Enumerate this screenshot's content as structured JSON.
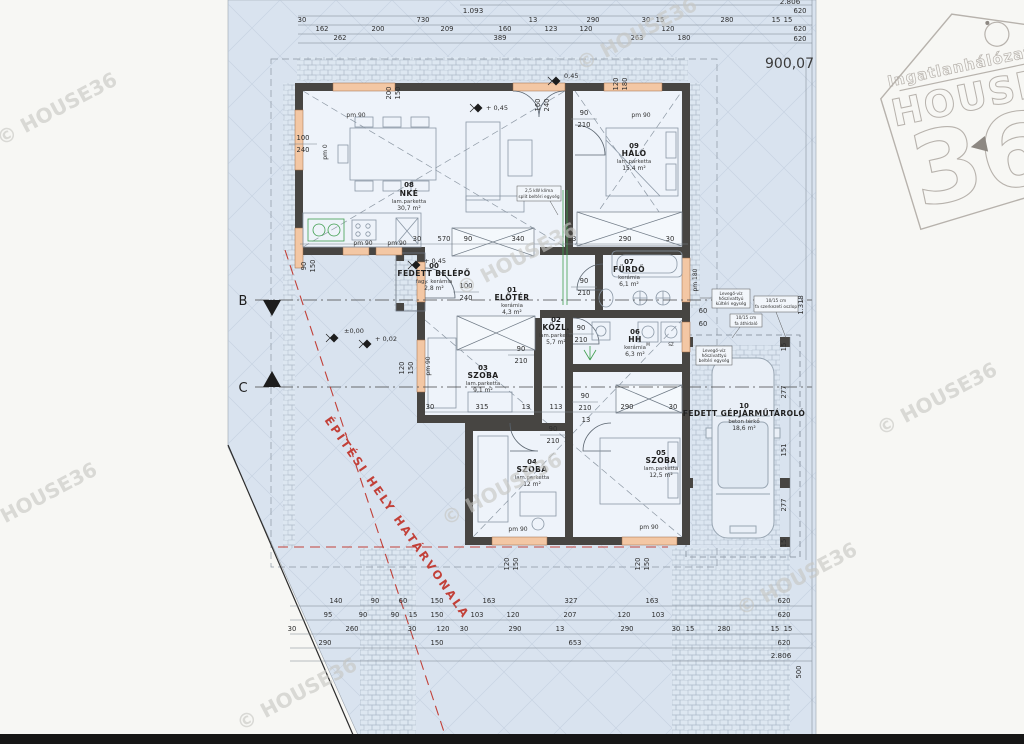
{
  "plot_number": "900,07",
  "watermark": "© HOUSE36",
  "boundary_label": "ÉPÍTÉSI HELY HATÁRVONALA",
  "logo": {
    "tagline": "Ingatlanhálózat",
    "name": "HOUSE",
    "number": "36"
  },
  "sections": {
    "b": "B",
    "c": "C"
  },
  "levels": {
    "zero": "±0,00",
    "p002": "+ 0,02",
    "p045": "+ 0,45",
    "v045": "0,45"
  },
  "pm": {
    "pm90": "pm 90",
    "pm0": "pm 0",
    "pm180": "pm 180"
  },
  "appliances": {
    "m": "M",
    "sz": "SZ"
  },
  "rooms": [
    {
      "num": "00",
      "name": "FEDETT BELÉPŐ",
      "material": "fagy. kerámia",
      "area": "2,8 m²"
    },
    {
      "num": "01",
      "name": "ELŐTÉR",
      "material": "kerámia",
      "area": "4,3 m²"
    },
    {
      "num": "02",
      "name": "KÖZL.",
      "material": "lam.parketta",
      "area": "5,7 m²"
    },
    {
      "num": "03",
      "name": "SZOBA",
      "material": "lam.parketta",
      "area": "9,1 m²"
    },
    {
      "num": "04",
      "name": "SZOBA",
      "material": "lam.parketta",
      "area": "12 m²"
    },
    {
      "num": "05",
      "name": "SZOBA",
      "material": "lam.parketta",
      "area": "12,5 m²"
    },
    {
      "num": "06",
      "name": "HH",
      "material": "kerámia",
      "area": "6,3 m²"
    },
    {
      "num": "07",
      "name": "FÜRDŐ",
      "material": "kerámia",
      "area": "6,1 m²"
    },
    {
      "num": "08",
      "name": "NKÉ",
      "material": "lam.parketta",
      "area": "30,7 m²"
    },
    {
      "num": "09",
      "name": "HÁLÓ",
      "material": "lam.parketta",
      "area": "15,4 m²"
    },
    {
      "num": "10",
      "name": "FEDETT GÉPJÁRMŰTÁROLÓ",
      "material": "beton térkő",
      "area": "18,6 m²"
    }
  ],
  "notes": {
    "klima": [
      "2,5 kW klíma",
      "split beltéri egység"
    ],
    "hp_out": [
      "Levegő-víz",
      "hőszivattyú",
      "kültéri egység"
    ],
    "post": [
      "10/15 cm",
      "fa szerkezeti oszlop"
    ],
    "lintel": [
      "10/15 cm",
      "fa áthidaló"
    ],
    "hp_in": [
      "Levegő-víz",
      "hőszivattyú",
      "beltéri egység"
    ]
  },
  "dims": {
    "t1": "1.093",
    "t_total": "2.806",
    "t620": [
      "620",
      "620",
      "620"
    ],
    "t2": [
      "30",
      "730",
      "13",
      "290",
      "30",
      "15",
      "280",
      "15",
      "15"
    ],
    "t3": [
      "162",
      "200",
      "209",
      "160",
      "123",
      "120",
      "120"
    ],
    "t4": [
      "262",
      "389",
      "263",
      "180"
    ],
    "b1": [
      "140",
      "90",
      "60",
      "150",
      "163",
      "327",
      "163",
      "620"
    ],
    "b2": [
      "95",
      "90",
      "90",
      "15",
      "150",
      "103",
      "120",
      "207",
      "120",
      "103",
      "620"
    ],
    "b3": [
      "30",
      "260",
      "30",
      "120",
      "30",
      "290",
      "13",
      "290",
      "30",
      "15",
      "280",
      "15",
      "15"
    ],
    "b4": [
      "290",
      "150",
      "653",
      "620"
    ],
    "b5": "2.806",
    "b_rot": "500",
    "garage_col": [
      "15",
      "277",
      "151",
      "277",
      "15"
    ],
    "garage_total": "1.318",
    "sixty": [
      "60",
      "60"
    ],
    "mid1": [
      "30",
      "570",
      "90",
      "340",
      "13",
      "290",
      "30"
    ],
    "mid2": [
      "30",
      "315",
      "13",
      "113",
      "290",
      "30",
      "13"
    ],
    "win_left": [
      "100",
      "240"
    ],
    "porch_door": [
      "100",
      "240"
    ],
    "door": [
      "90",
      "210"
    ],
    "w200150": [
      "200",
      "150"
    ],
    "w160240": [
      "160",
      "240"
    ],
    "w120180": [
      "120",
      "180"
    ],
    "w120150": [
      "120",
      "150"
    ],
    "w90150": [
      "90",
      "150"
    ]
  }
}
